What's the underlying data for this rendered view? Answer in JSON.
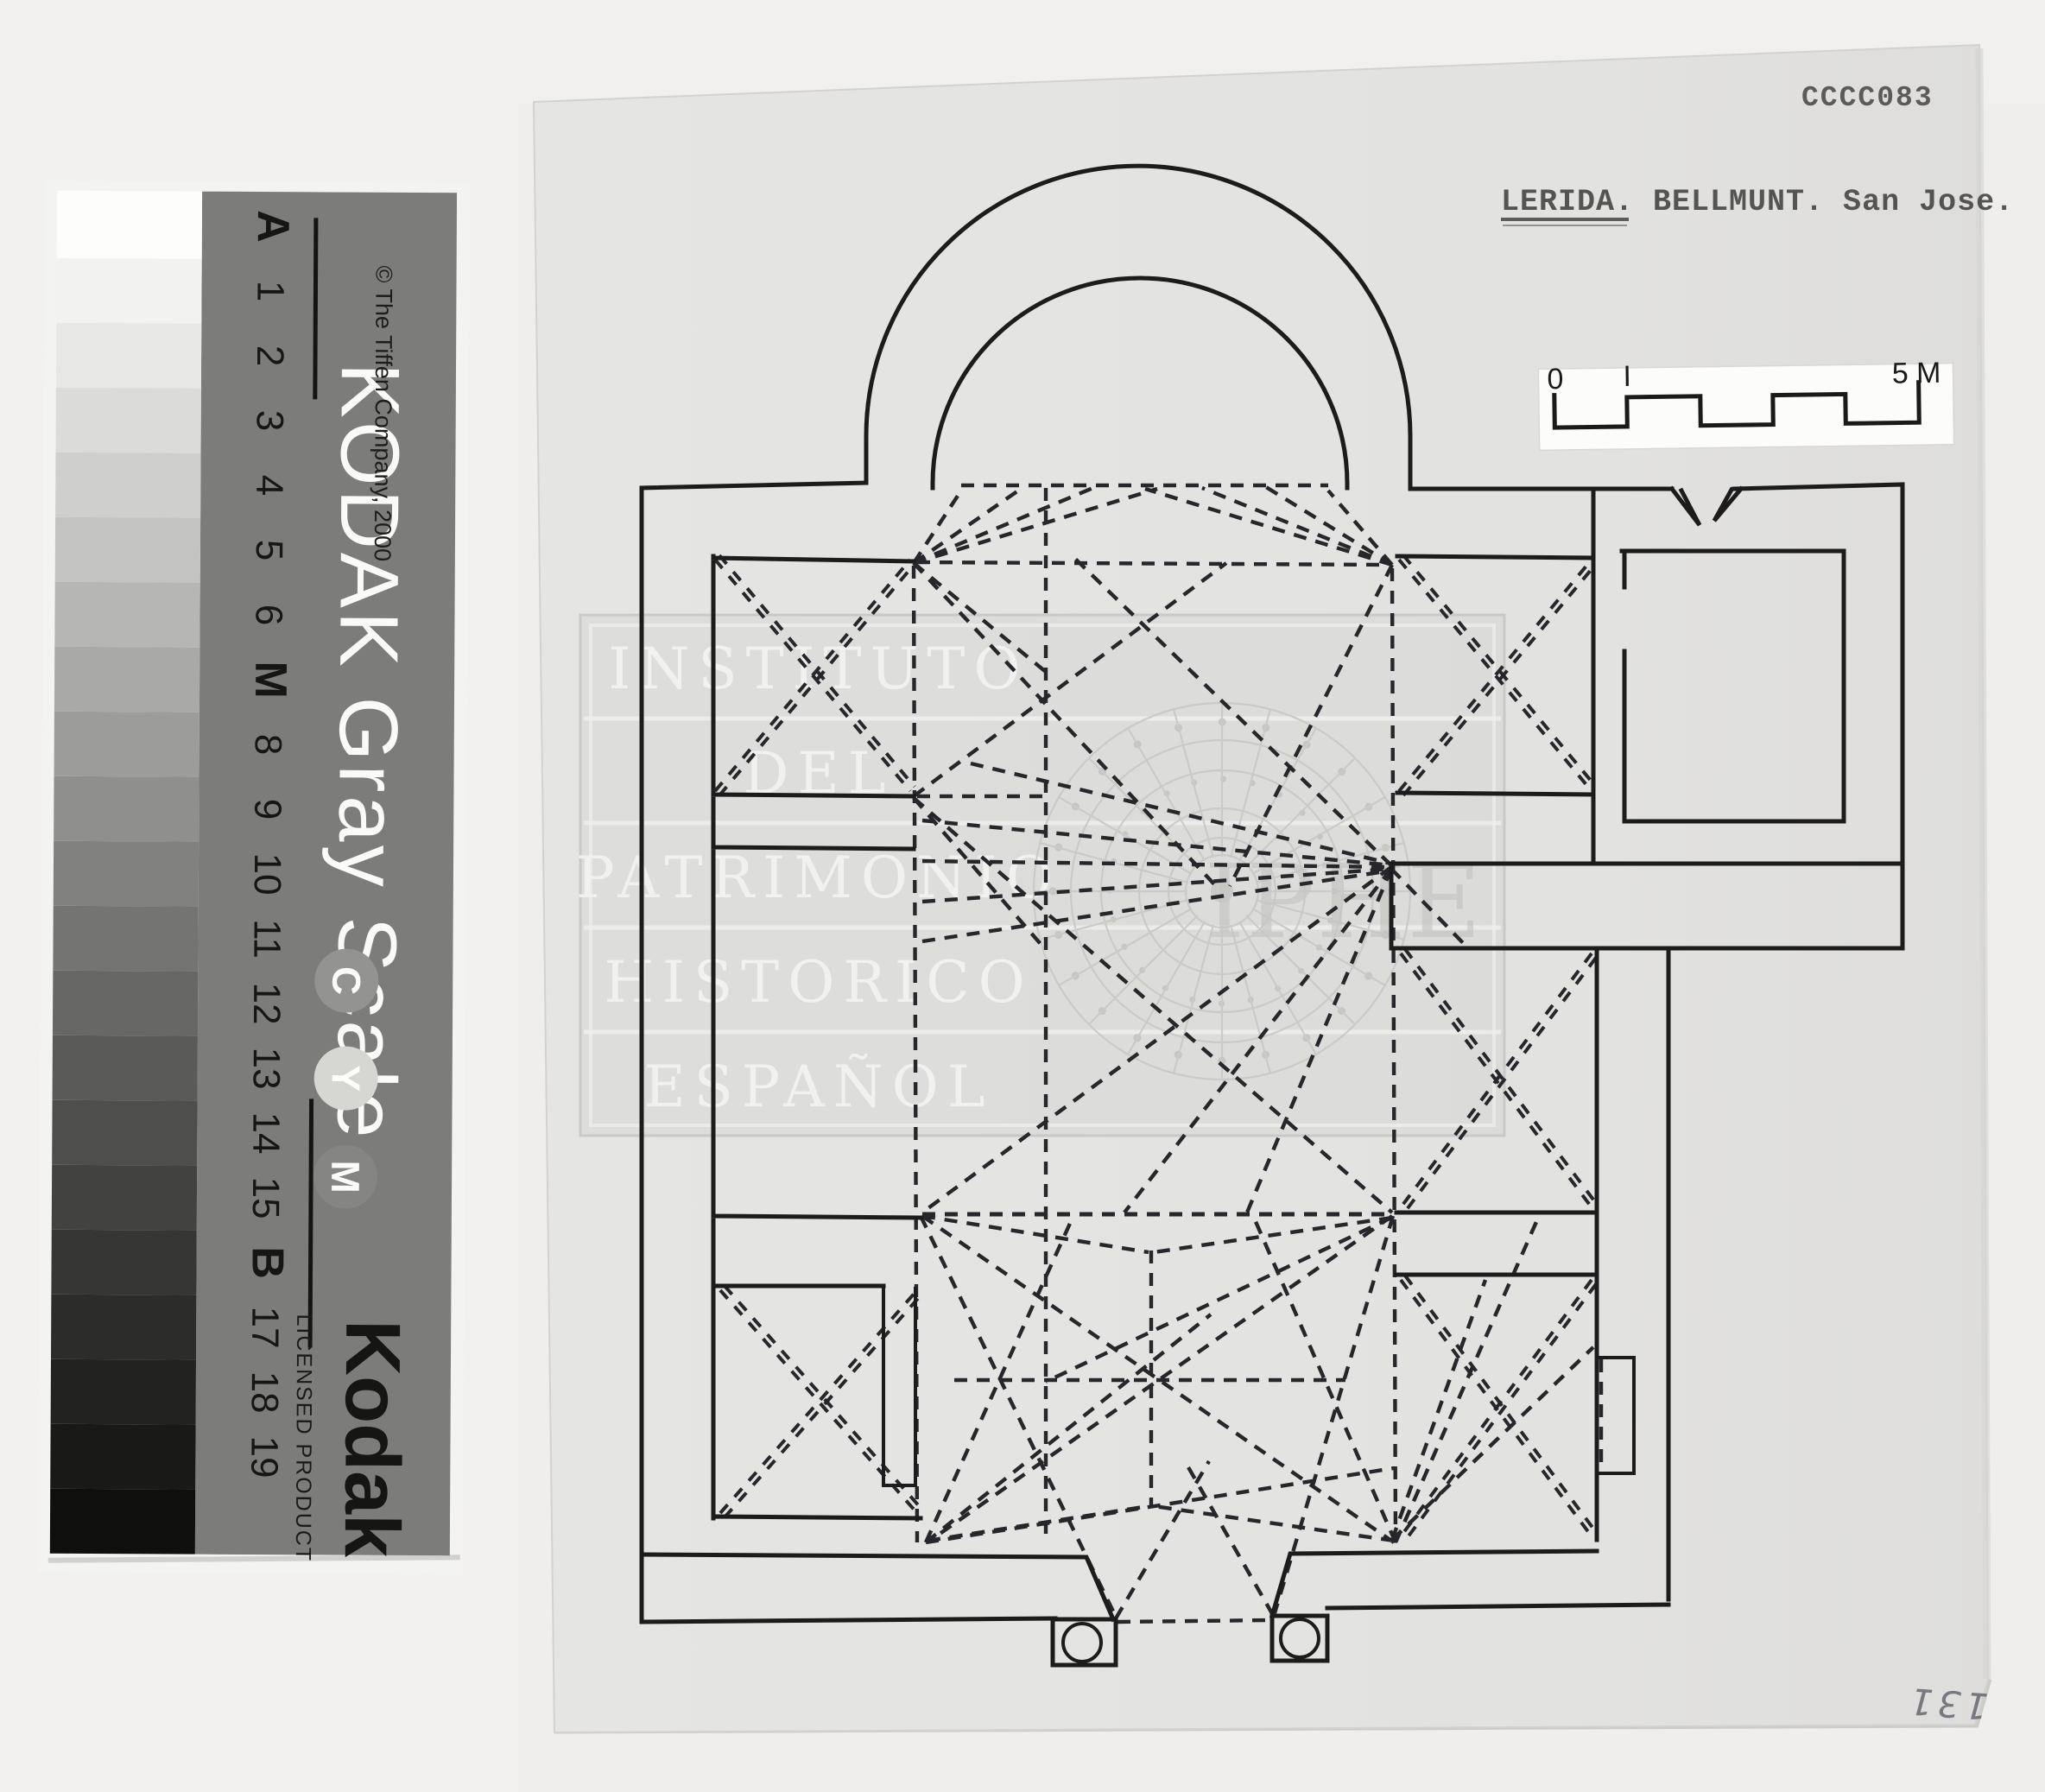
{
  "stamp": {
    "code": "CCCC083",
    "title": "LERIDA. BELLMUNT. San Jose."
  },
  "scale_bar": {
    "zero": "0",
    "one": "I",
    "five": "5 M"
  },
  "watermark": {
    "rows": [
      "INSTITUTO",
      "DEL",
      "PATRIMONIO",
      "HISTORICO",
      "ESPAÑOL"
    ],
    "monogram": "IPHE"
  },
  "annotations": {
    "page_number": "131"
  },
  "kodak_strip": {
    "title": "KODAK Gray Scale",
    "copyright": "© The Tiffen Company, 2000",
    "brand": "Kodak",
    "brand_subtitle": "LICENSED PRODUCT",
    "index_labels": [
      "A",
      "1",
      "2",
      "3",
      "4",
      "5",
      "6",
      "M",
      "8",
      "9",
      "10",
      "11",
      "12",
      "13",
      "14",
      "15",
      "B",
      "17",
      "18",
      "19"
    ],
    "ink_labels": [
      "C",
      "Y",
      "M"
    ],
    "patch_grays": [
      "#fdfdfb",
      "#f2f2f0",
      "#e7e7e5",
      "#dbdbd9",
      "#cfcfcd",
      "#c3c3c1",
      "#b6b6b4",
      "#a9a9a7",
      "#9c9c9a",
      "#8f8f8d",
      "#818180",
      "#747472",
      "#676765",
      "#5a5a58",
      "#4e4e4c",
      "#424240",
      "#363634",
      "#2c2c2a",
      "#222220",
      "#191917",
      "#0f0f0d"
    ]
  },
  "colors": {
    "background": "#efeeec",
    "paper_sheet": "#e3e3e1",
    "panel_gray": "#7c7c7a",
    "ink": "#1c1c1c",
    "rose_gray": "#c7c7c5"
  }
}
